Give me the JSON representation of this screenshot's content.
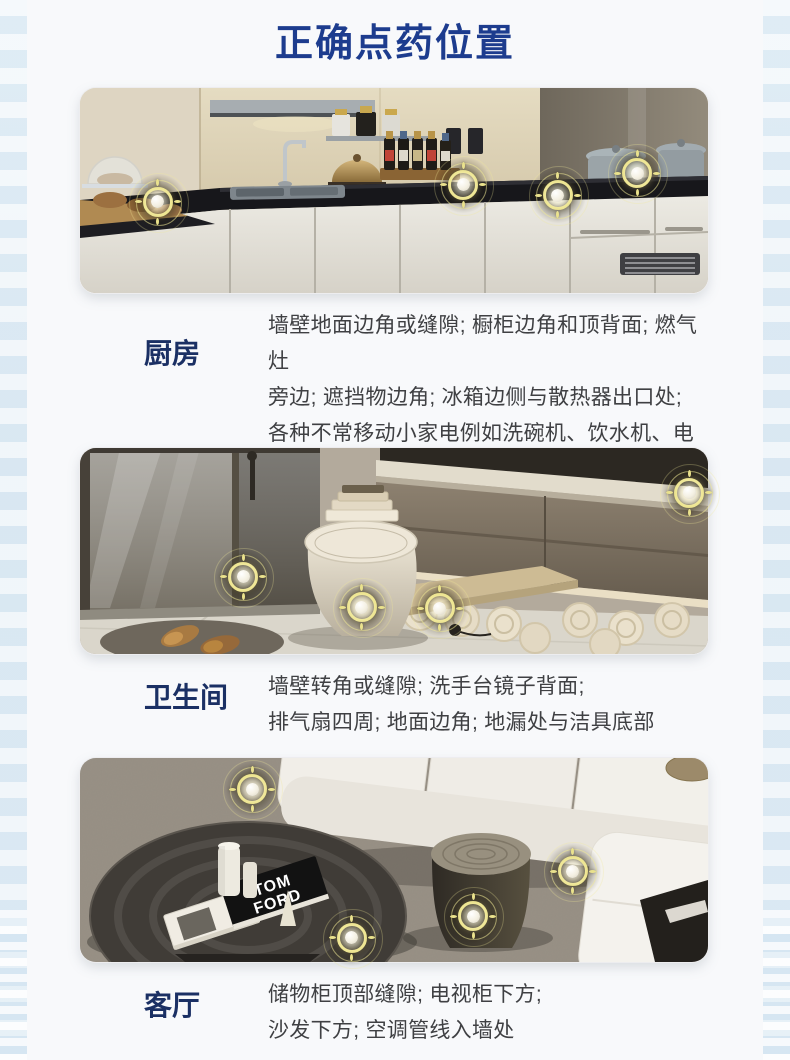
{
  "page": {
    "title": "正确点药位置"
  },
  "theme": {
    "title_color": "#1d3c8e",
    "label_color": "#1b3064",
    "text_color": "#3f4043",
    "marker_ring_color": "#ece387",
    "panel_bg": "#f8f9fb",
    "strip_bg": "#e2edf4"
  },
  "sections": [
    {
      "id": "kitchen",
      "label": "厨房",
      "lines": [
        "墙壁地面边角或缝隙; 橱柜边角和顶背面; 燃气灶",
        "旁边; 遮挡物边角; 冰箱边侧与散热器出口处;",
        "各种不常移动小家电例如洗碗机、饮水机、电饭煲",
        "等背面的墙壁或台面处"
      ],
      "photo": "kitchen-counter-with-stove-and-sink",
      "markers": [
        {
          "x": 12.4,
          "y": 55.6
        },
        {
          "x": 61.0,
          "y": 47.3
        },
        {
          "x": 76.1,
          "y": 52.2
        },
        {
          "x": 88.7,
          "y": 41.5
        }
      ]
    },
    {
      "id": "bathroom",
      "label": "卫生间",
      "lines": [
        "墙壁转角或缝隙; 洗手台镜子背面;",
        "排气扇四周; 地面边角; 地漏处与洁具底部"
      ],
      "photo": "bathroom-toilet-shower-vanity",
      "markers": [
        {
          "x": 26.0,
          "y": 62.6
        },
        {
          "x": 44.9,
          "y": 77.2
        },
        {
          "x": 57.3,
          "y": 77.7
        },
        {
          "x": 97.0,
          "y": 21.8
        }
      ]
    },
    {
      "id": "living",
      "label": "客厅",
      "lines": [
        "储物柜顶部缝隙; 电视柜下方;",
        "沙发下方; 空调管线入墙处"
      ],
      "photo": "living-room-sofa-coffee-table",
      "photo_text_lines": [
        "TOM",
        "FORD"
      ],
      "markers": [
        {
          "x": 27.4,
          "y": 15.2
        },
        {
          "x": 78.5,
          "y": 55.4
        },
        {
          "x": 62.6,
          "y": 77.5
        },
        {
          "x": 43.3,
          "y": 88.2
        }
      ]
    }
  ]
}
